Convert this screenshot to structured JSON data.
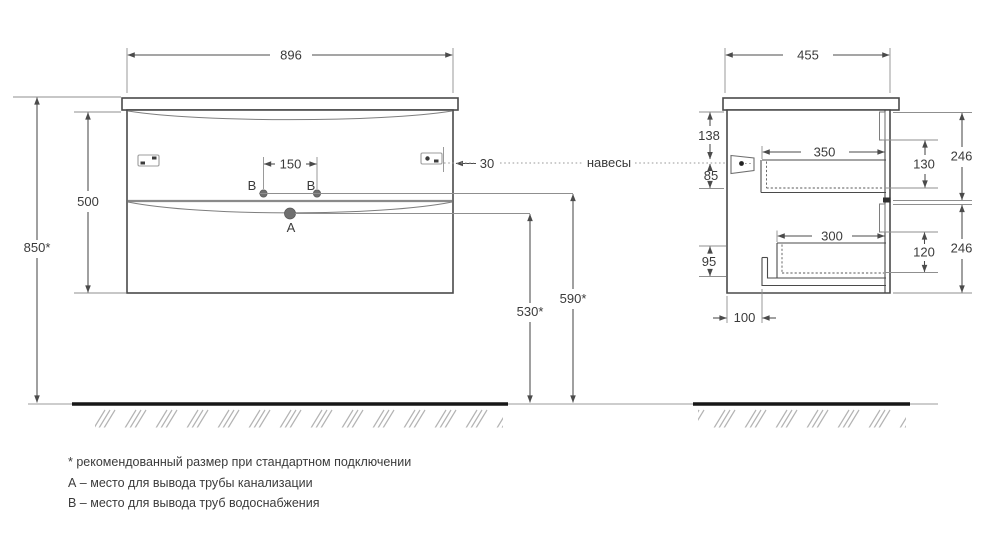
{
  "labels": {
    "hangers": "навесы"
  },
  "front_view": {
    "width": "896",
    "body_height": "500",
    "wall_mount_height": "850*",
    "supply_spacing": "150",
    "hanger_edge_offset": "30",
    "supply_left": "B",
    "supply_right": "B",
    "drain": "A",
    "drain_outlet_height": "530*",
    "supply_outlet_height": "590*"
  },
  "side_view": {
    "depth": "455",
    "top_to_hanger": "138",
    "hanger_to_drawer": "85",
    "drawer_top_depth": "350",
    "drawer_top_height": "130",
    "front_top_height": "246",
    "drawer_bottom_depth": "300",
    "drawer_bottom_height": "120",
    "front_bottom_height": "246",
    "back_clearance": "95",
    "channel_offset": "100"
  },
  "footnotes": [
    "* рекомендованный размер при стандартном подключении",
    "А – место для вывода трубы канализации",
    "B – место для вывода труб водоснабжения"
  ],
  "colors": {
    "line": "#4b4b4b",
    "point": "#6f6f6f",
    "hatch": "#b3b3b3",
    "text": "#3b3b3b",
    "floor": "#171717",
    "background": "#ffffff"
  }
}
